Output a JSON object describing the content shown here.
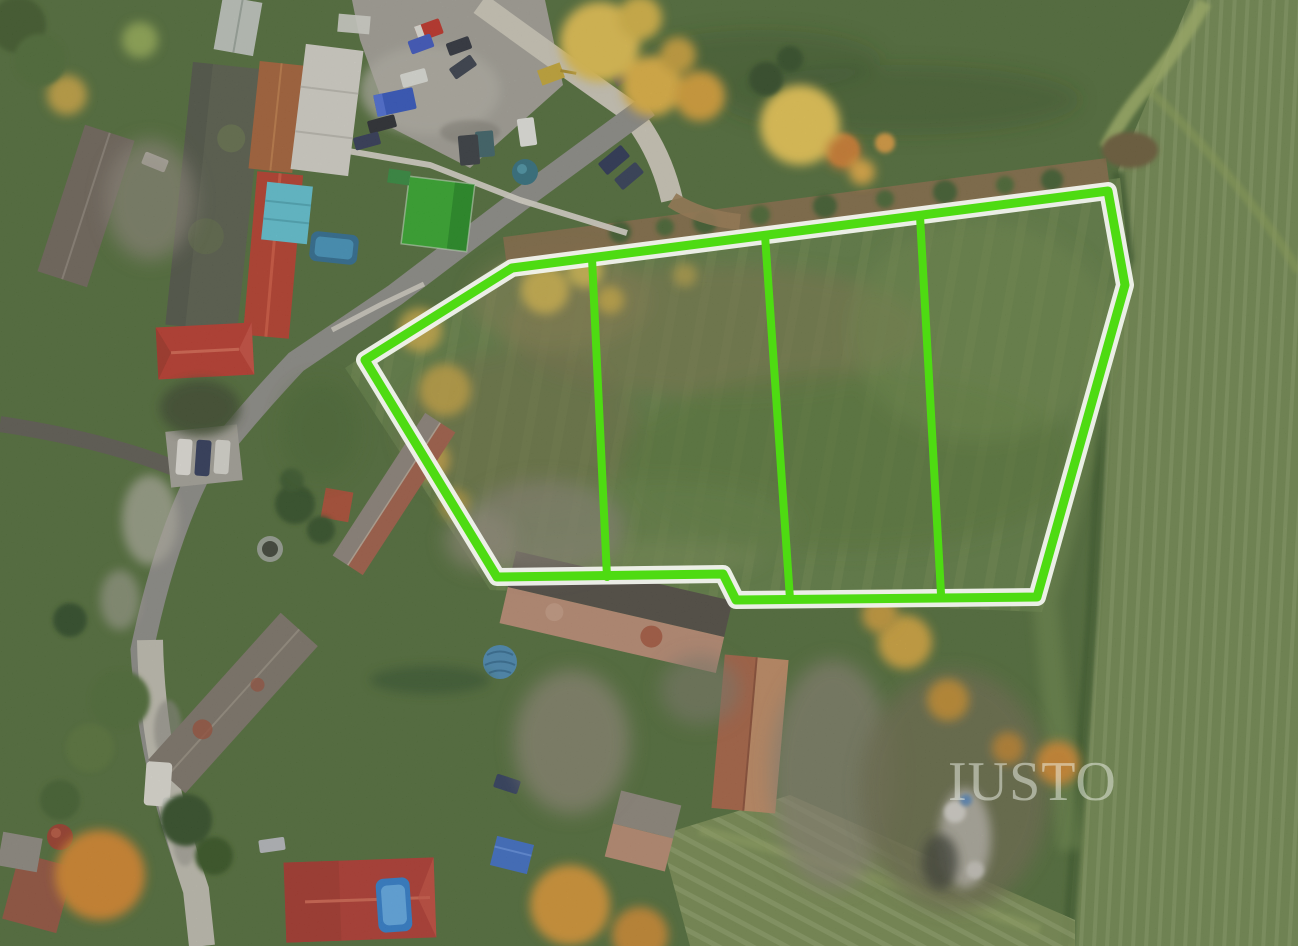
{
  "image": {
    "width": 1298,
    "height": 946,
    "description": "Aerial drone photograph of a village edge in autumn with a building-plot meadow outlined in bright green and split into four lots; farm buildings, red roofs, roads, parked cars, autumn trees and crop fields surround it"
  },
  "watermark": {
    "text": "IUSTO",
    "color": "#eff3ea",
    "opacity": 0.5
  },
  "parcel": {
    "outline_color": "#4edb12",
    "halo_color": "#f2f4ee",
    "lot_count": 4,
    "outline_points": "365,360 512,268 1108,191 1125,285 1037,597 736,600 723,574 497,577",
    "dividers": [
      {
        "points": "592,258 607,577"
      },
      {
        "points": "765,235 790,599"
      },
      {
        "points": "920,216 941,594"
      }
    ]
  }
}
